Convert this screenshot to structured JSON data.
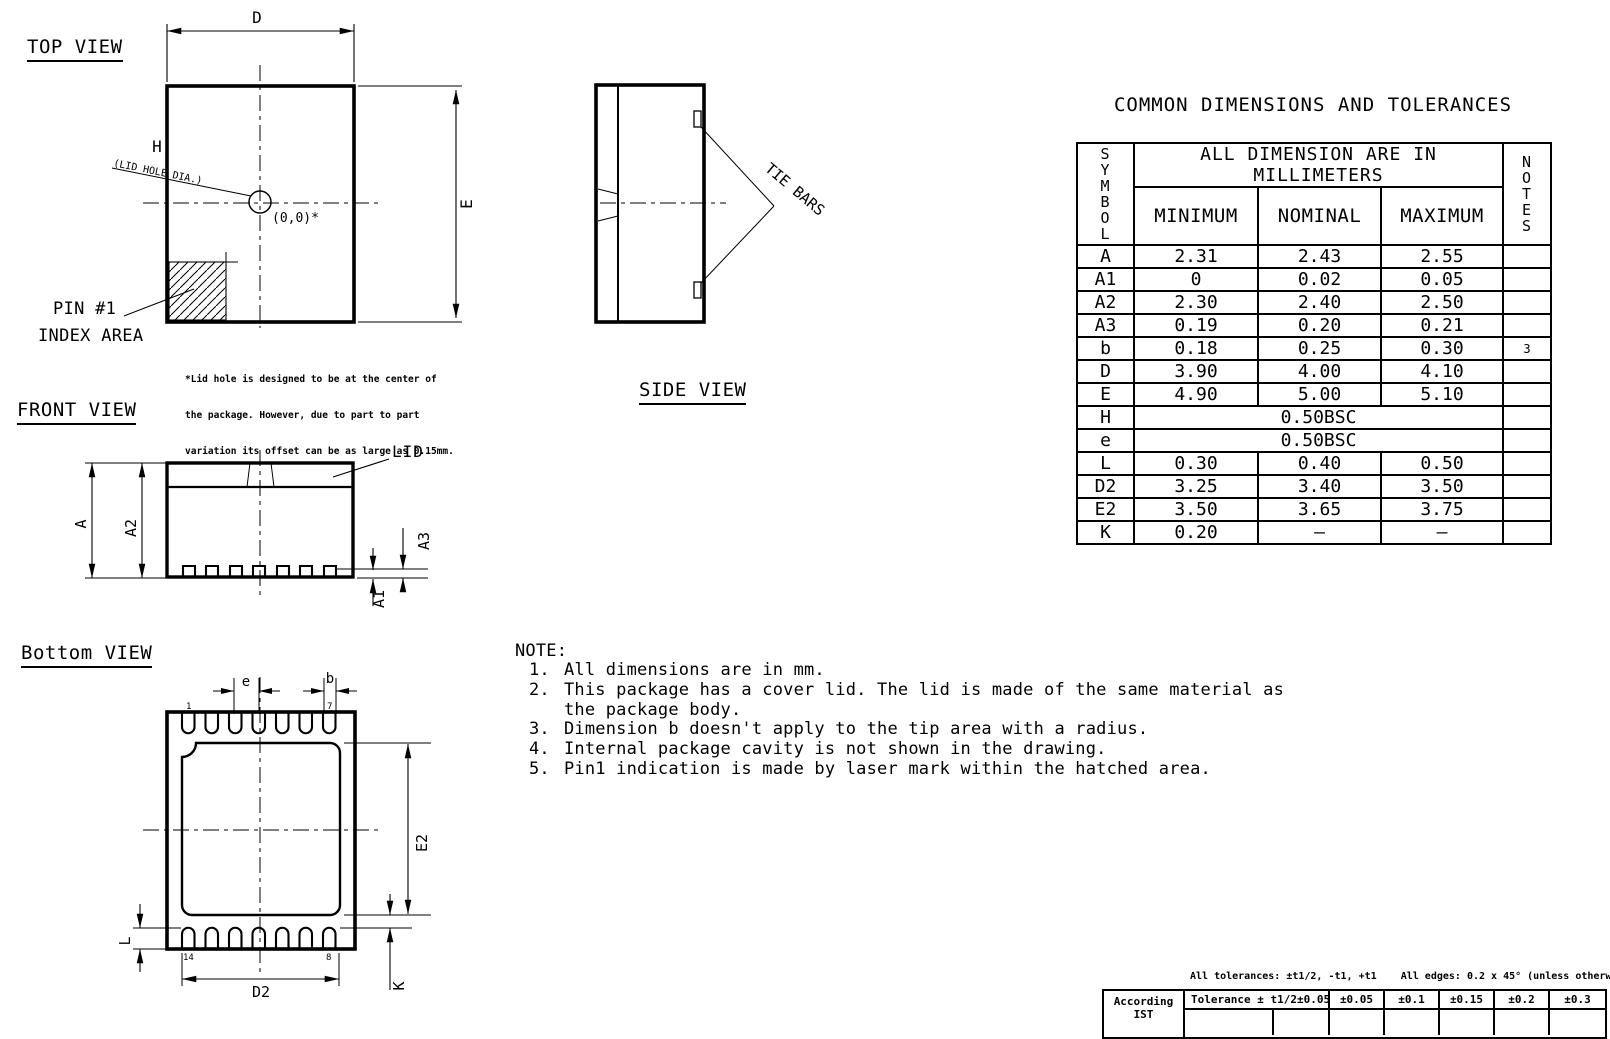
{
  "page": {
    "background": "#ffffff",
    "line_color": "#000000"
  },
  "views": {
    "top": {
      "title": "TOP VIEW",
      "dim_d": "D",
      "dim_e": "E",
      "dim_h": "H",
      "lid_hole_label": "(LID HOLE DIA.)",
      "origin_label": "(0,0)*",
      "pin1_label_line1": "PIN #1",
      "pin1_label_line2": "INDEX AREA",
      "lid_note_line1": "*Lid hole is designed to be at the center of",
      "lid_note_line2": "the package. However, due to part to part",
      "lid_note_line3": "variation its offset can be as large as 0.15mm."
    },
    "side": {
      "title": "SIDE VIEW",
      "tie_bars": "TIE BARS"
    },
    "front": {
      "title": "FRONT VIEW",
      "lid": "LID",
      "dim_a": "A",
      "dim_a2": "A2",
      "dim_a3": "A3",
      "dim_a1": "A1"
    },
    "bottom": {
      "title": "Bottom VIEW",
      "dim_pitch": "e",
      "dim_b": "b",
      "dim_e2": "E2",
      "dim_l": "L",
      "dim_d2": "D2",
      "dim_k": "K",
      "pin1": "1",
      "pin7": "7",
      "pin14": "14",
      "pin8": "8"
    }
  },
  "dim_table": {
    "title": "COMMON DIMENSIONS AND TOLERANCES",
    "symbol_header": "SYMBOL",
    "units_header": "ALL DIMENSION ARE IN MILLIMETERS",
    "min_header": "MINIMUM",
    "nom_header": "NOMINAL",
    "max_header": "MAXIMUM",
    "notes_header": "NOTES",
    "rows": [
      {
        "symbol": "A",
        "min": "2.31",
        "nom": "2.43",
        "max": "2.55",
        "note": ""
      },
      {
        "symbol": "A1",
        "min": "0",
        "nom": "0.02",
        "max": "0.05",
        "note": ""
      },
      {
        "symbol": "A2",
        "min": "2.30",
        "nom": "2.40",
        "max": "2.50",
        "note": ""
      },
      {
        "symbol": "A3",
        "min": "0.19",
        "nom": "0.20",
        "max": "0.21",
        "note": ""
      },
      {
        "symbol": "b",
        "min": "0.18",
        "nom": "0.25",
        "max": "0.30",
        "note": "3"
      },
      {
        "symbol": "D",
        "min": "3.90",
        "nom": "4.00",
        "max": "4.10",
        "note": ""
      },
      {
        "symbol": "E",
        "min": "4.90",
        "nom": "5.00",
        "max": "5.10",
        "note": ""
      },
      {
        "symbol": "H",
        "span": "0.50BSC",
        "note": ""
      },
      {
        "symbol": "e",
        "span": "0.50BSC",
        "note": ""
      },
      {
        "symbol": "L",
        "min": "0.30",
        "nom": "0.40",
        "max": "0.50",
        "note": ""
      },
      {
        "symbol": "D2",
        "min": "3.25",
        "nom": "3.40",
        "max": "3.50",
        "note": ""
      },
      {
        "symbol": "E2",
        "min": "3.50",
        "nom": "3.65",
        "max": "3.75",
        "note": ""
      },
      {
        "symbol": "K",
        "min": "0.20",
        "nom": "–",
        "max": "–",
        "note": ""
      }
    ]
  },
  "notes": {
    "heading": "NOTE:",
    "items": [
      {
        "num": "1.",
        "text": "All dimensions are in mm."
      },
      {
        "num": "2.",
        "text": "This package has a cover lid. The lid is made of the same material as"
      },
      {
        "num": "",
        "text": "the package body."
      },
      {
        "num": "3.",
        "text": "Dimension b doesn't apply to the tip area with a radius."
      },
      {
        "num": "4.",
        "text": "Internal package cavity is not shown in the drawing."
      },
      {
        "num": "5.",
        "text": "Pin1 indication is made by laser mark within the hatched area."
      }
    ]
  },
  "tolerance_block": {
    "note": "All tolerances: ±t1/2, -t1, +t1    All edges: 0.2 x 45° (unless otherwise sp",
    "according_line1": "According",
    "according_line2": "IST",
    "row_label": "Tolerance ± t1/2",
    "values": [
      "±0.05",
      "±0.05",
      "±0.1",
      "±0.15",
      "±0.2",
      "±0.3"
    ]
  }
}
